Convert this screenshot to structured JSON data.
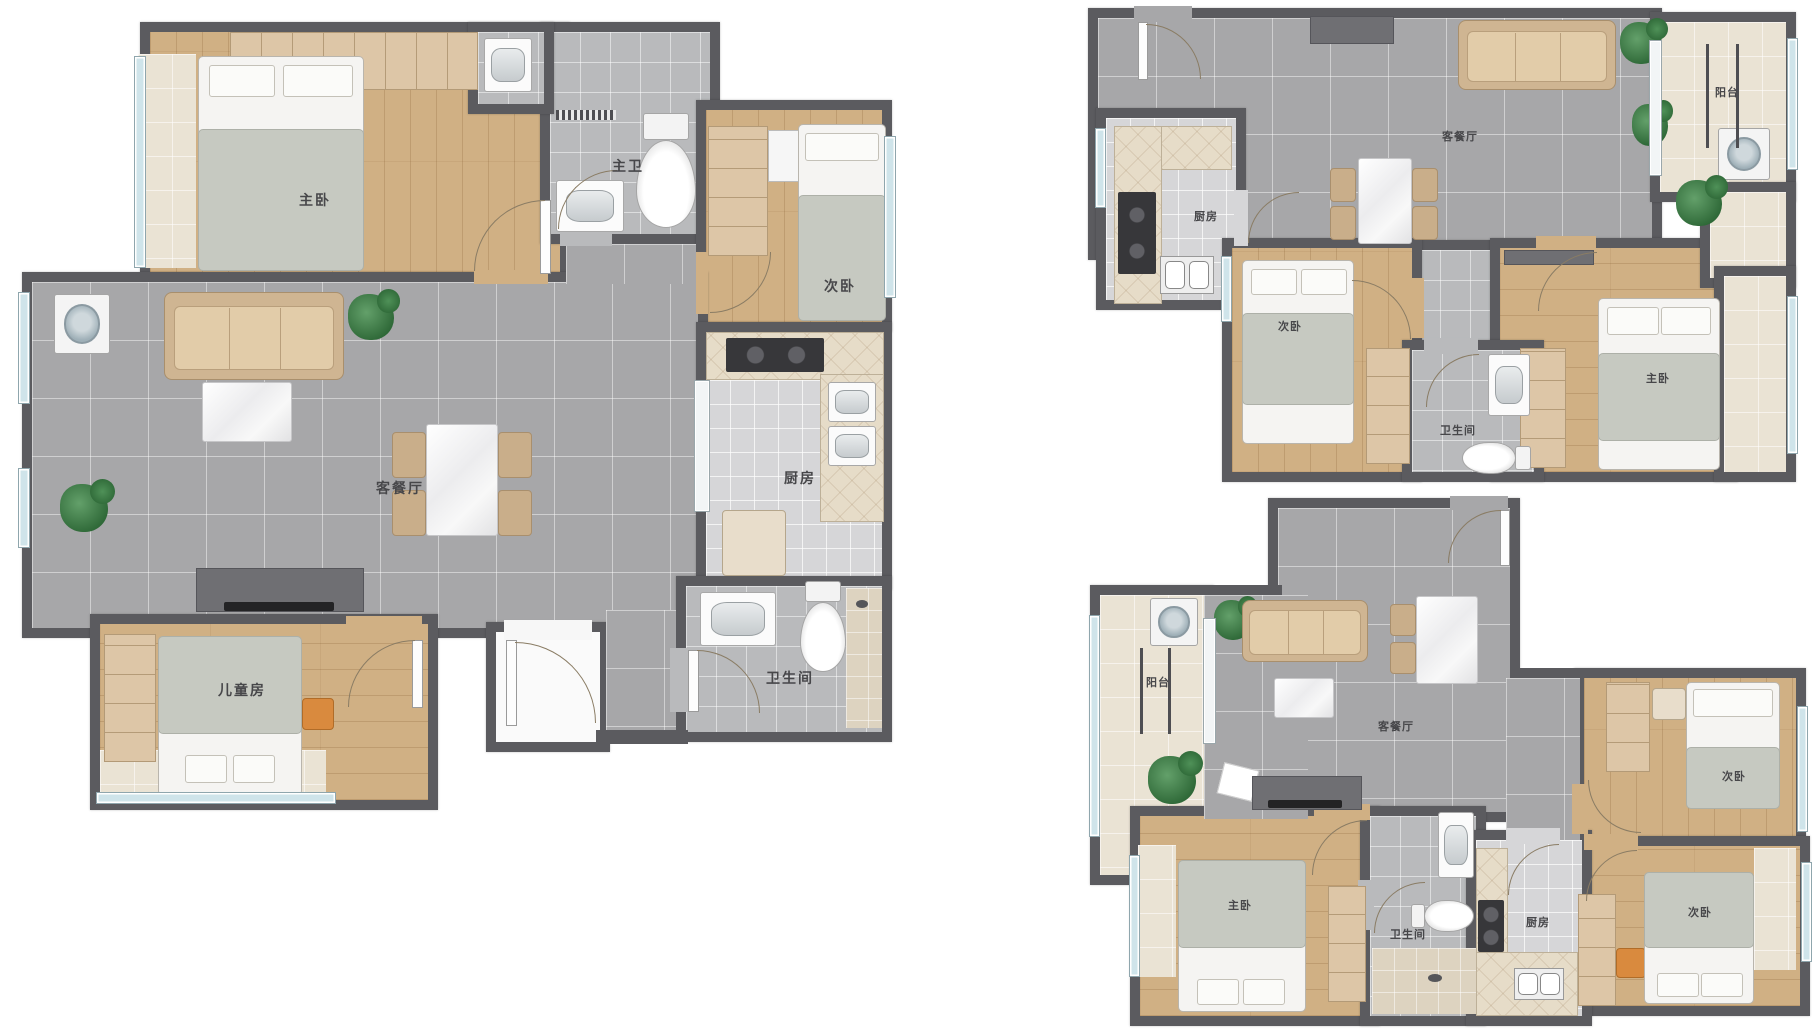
{
  "plans": {
    "A": {
      "name": "large-three-bedroom-floor-plan",
      "labels": {
        "master": "主卧",
        "master_bath": "主卫",
        "second": "次卧",
        "living": "客餐厅",
        "kitchen": "厨房",
        "bath": "卫生间",
        "kids": "儿童房"
      }
    },
    "B": {
      "name": "top-right-two-bedroom-floor-plan",
      "labels": {
        "living": "客餐厅",
        "kitchen": "厨房",
        "second": "次卧",
        "master": "主卧",
        "bath": "卫生间",
        "balcony": "阳台"
      }
    },
    "C": {
      "name": "bottom-right-three-bedroom-floor-plan",
      "labels": {
        "balcony": "阳台",
        "living": "客餐厅",
        "master": "主卧",
        "bath": "卫生间",
        "kitchen": "厨房",
        "second_top": "次卧",
        "second_bottom": "次卧"
      }
    }
  },
  "colors": {
    "wall": "#5b5b5f",
    "wood_floor": "#d0b084",
    "living_tile": "#a7a7a9",
    "bath_tile": "#b9babc",
    "kitchen_tile": "#d6d6d8",
    "balcony_cream": "#eae3d4",
    "window_blue": "#cfe4ea",
    "plant_green": "#2e6837",
    "stool_orange": "#d98a3e",
    "label_text": "#47474a"
  }
}
